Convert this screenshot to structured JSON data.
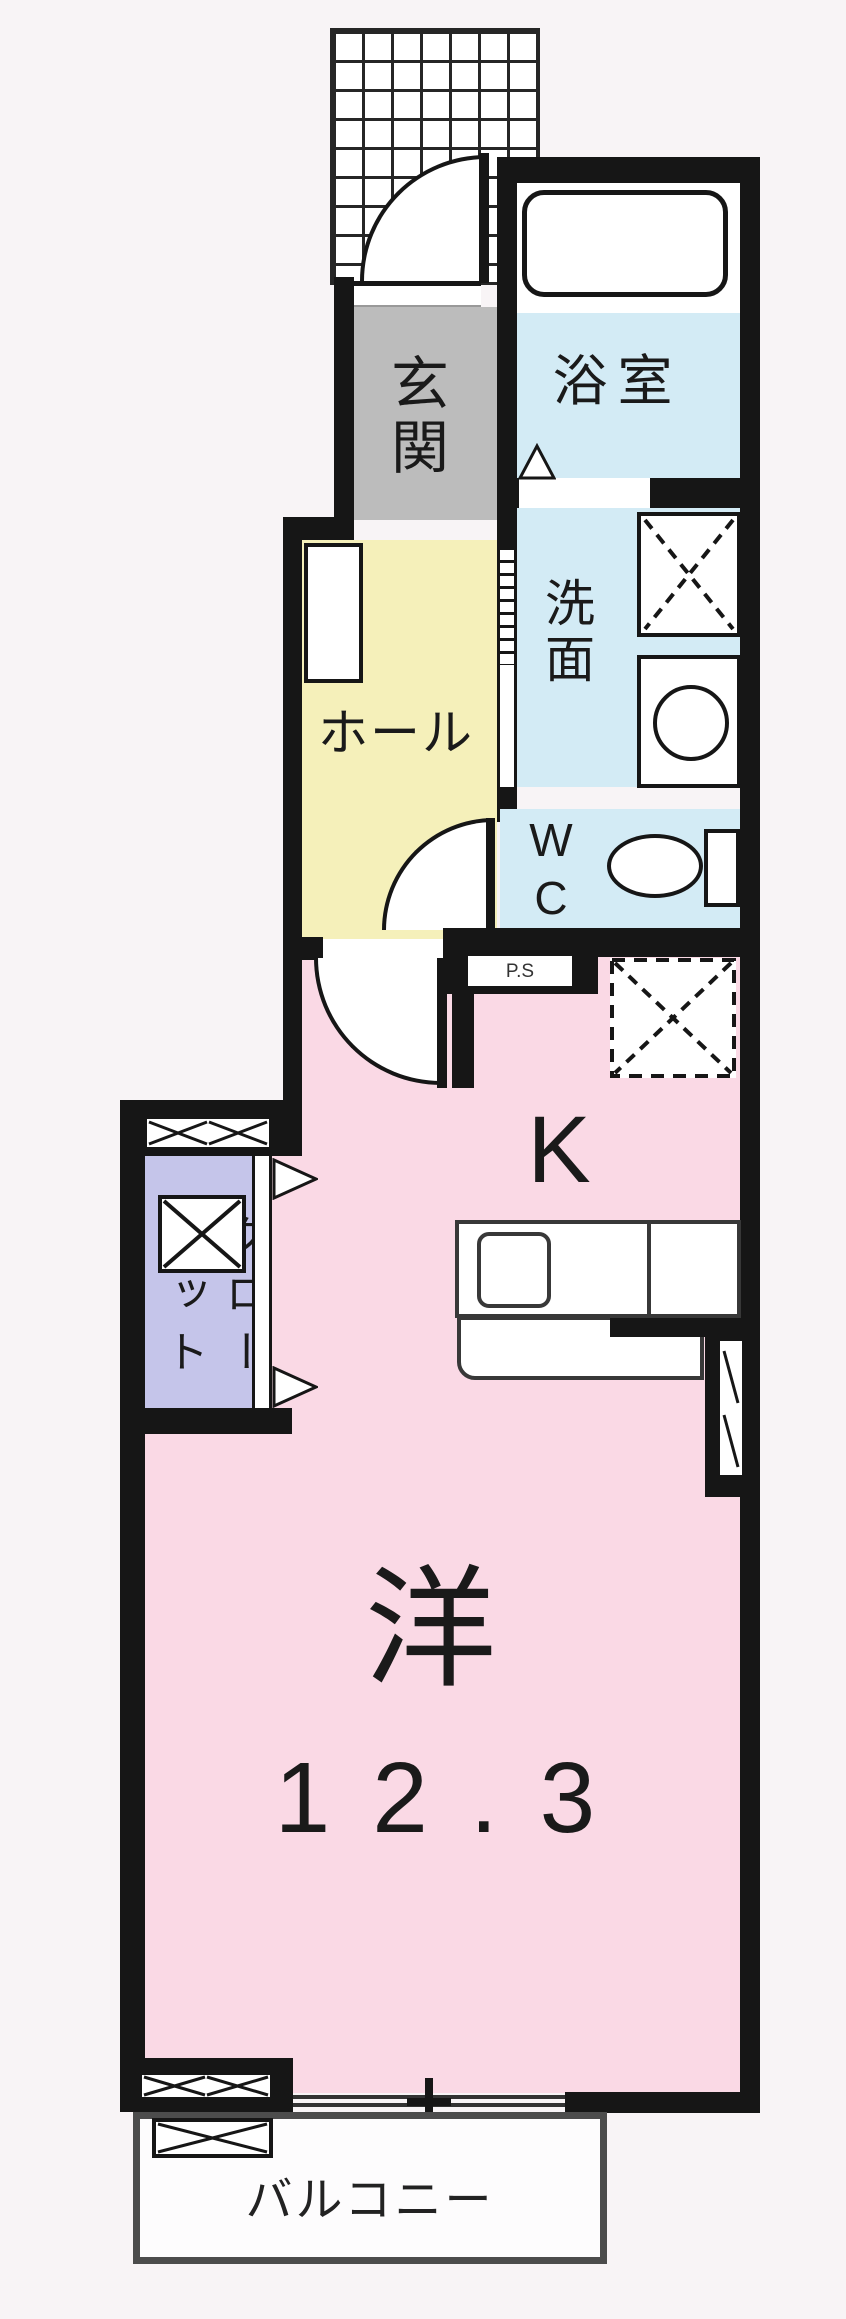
{
  "title": "one-room apartment floor plan",
  "rooms": {
    "genkan": "玄関",
    "bathroom": "浴室",
    "washroom": "洗面",
    "hall": "ホール",
    "wc_line1": "W",
    "wc_line2": "C",
    "pipe_space": "P.S",
    "kitchen": "K",
    "room_label": "洋",
    "room_size": "12.3",
    "closet_full": "クローゼット",
    "closet_col_right": "クロー",
    "closet_col_left": "ゼット",
    "balcony": "バルコニー"
  },
  "colors": {
    "outside": "#f8f4f6",
    "wall": "#161616",
    "pink": "#fad9e5",
    "yellow": "#f5f0ba",
    "gray": "#bcbcbc",
    "blue": "#d3ebf5",
    "purple": "#c5c5ea",
    "counter": "#383838",
    "balcony-border": "#4c4c4c",
    "text": "#1a1a1a"
  }
}
